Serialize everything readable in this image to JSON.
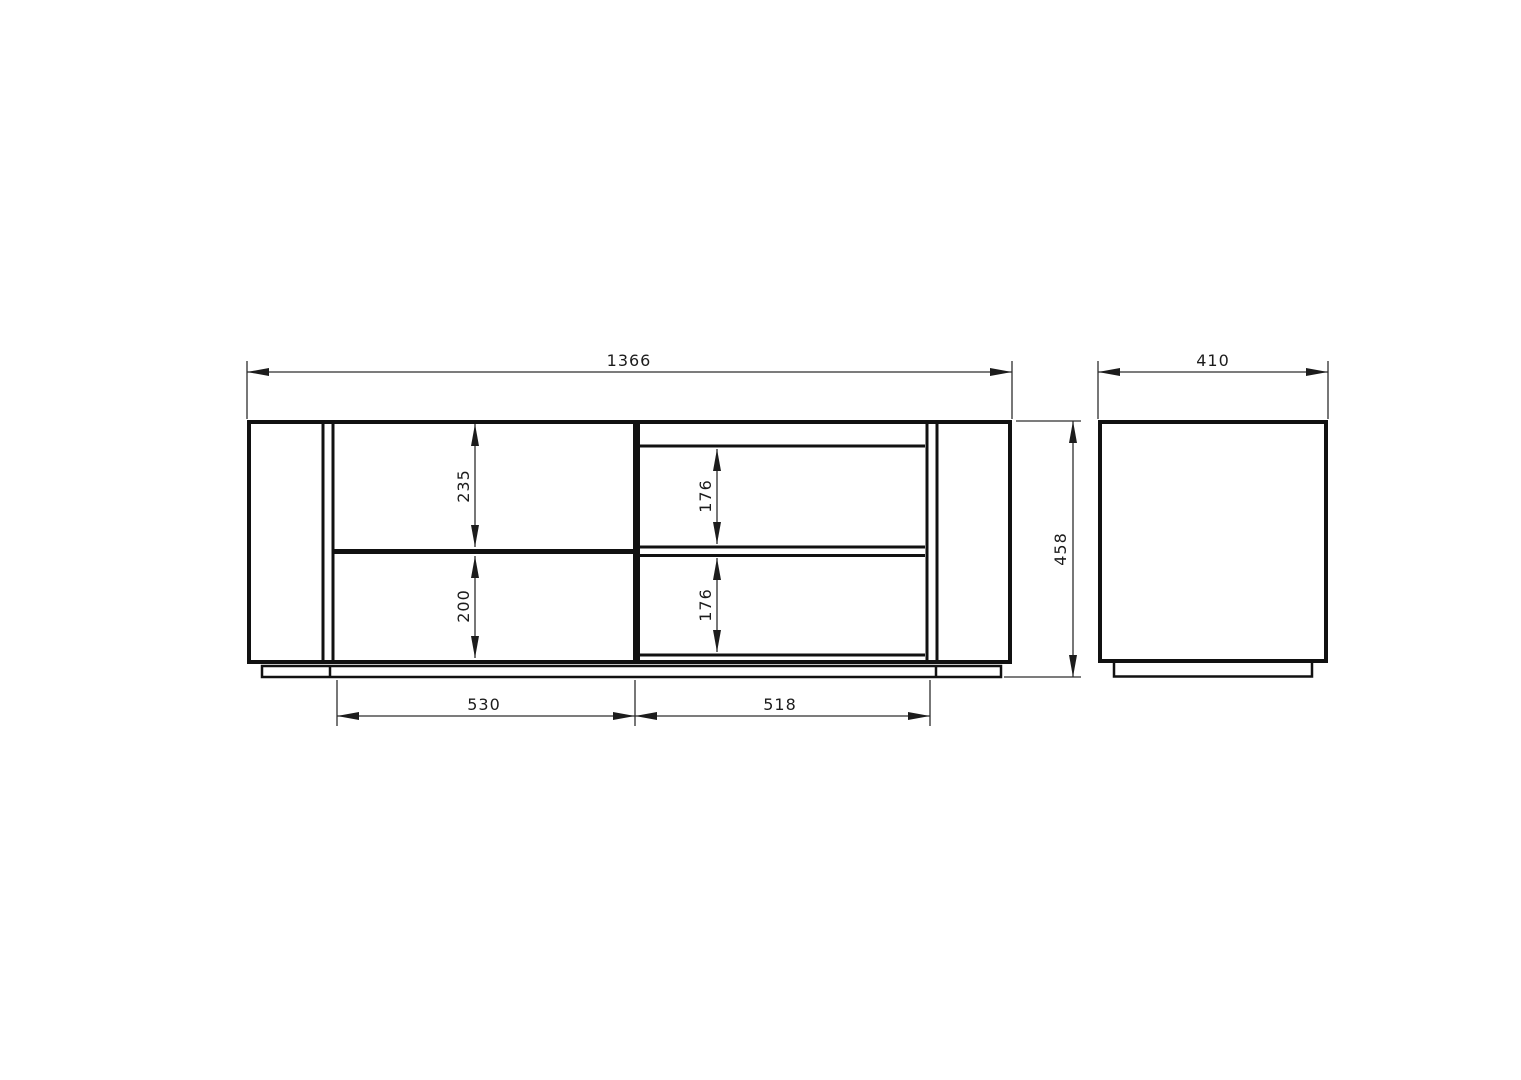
{
  "drawing": {
    "kind": "furniture-dimension-drawing",
    "colors": {
      "background": "#ffffff",
      "outline": "#111111",
      "dimension": "#2e2e2e"
    },
    "front_view": {
      "overall_width_mm": "1366",
      "overall_height_mm": "458",
      "upper_drawer_height_mm": "235",
      "lower_drawer_height_mm": "200",
      "upper_shelf_height_mm": "176",
      "lower_shelf_height_mm": "176",
      "left_opening_width_mm": "530",
      "right_opening_width_mm": "518"
    },
    "side_view": {
      "depth_mm": "410"
    }
  }
}
